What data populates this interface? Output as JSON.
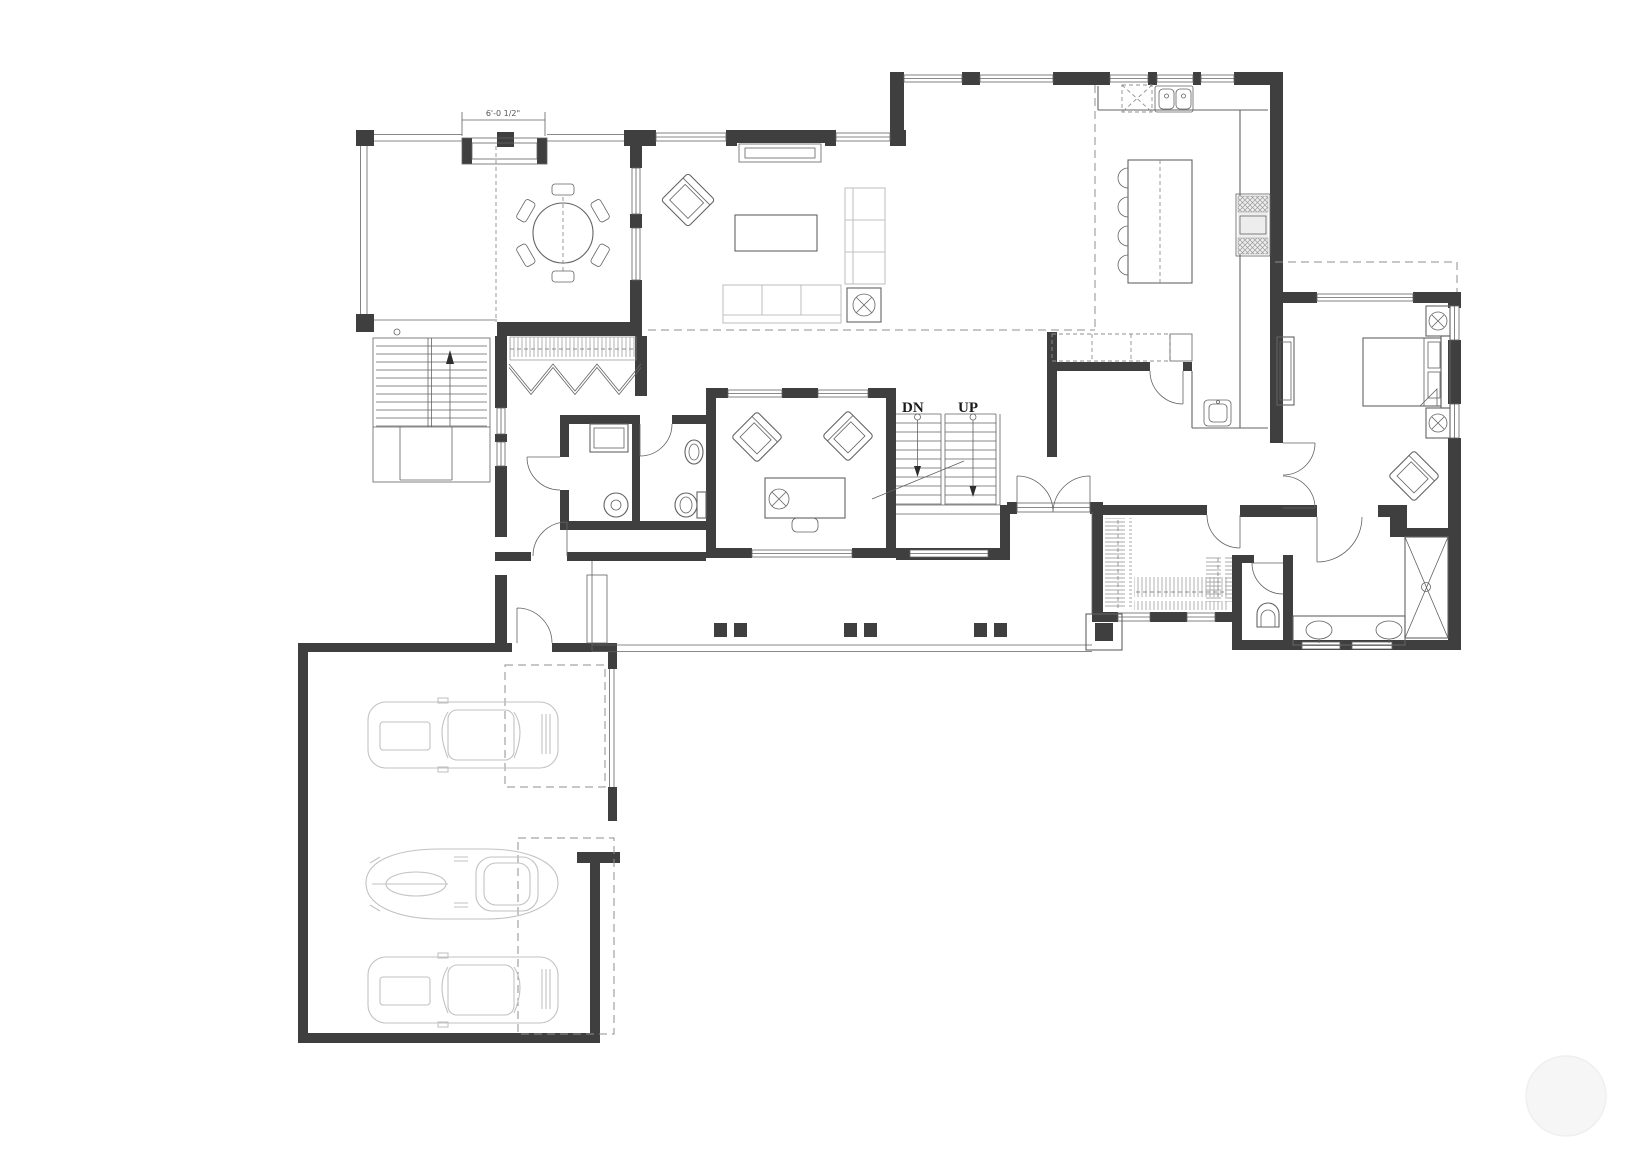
{
  "plan": {
    "labels": {
      "stairs_down": "DN",
      "stairs_up": "UP",
      "window_dimension": "6'-0 1/2\""
    }
  },
  "colors": {
    "background": "#ffffff",
    "wall": "#3f3f3f",
    "line": "#636363",
    "ghost": "#c2c2c2",
    "dash": "#8f8f8f",
    "hatch": "#a8a8a8",
    "watermark": "#f6f6f6"
  }
}
